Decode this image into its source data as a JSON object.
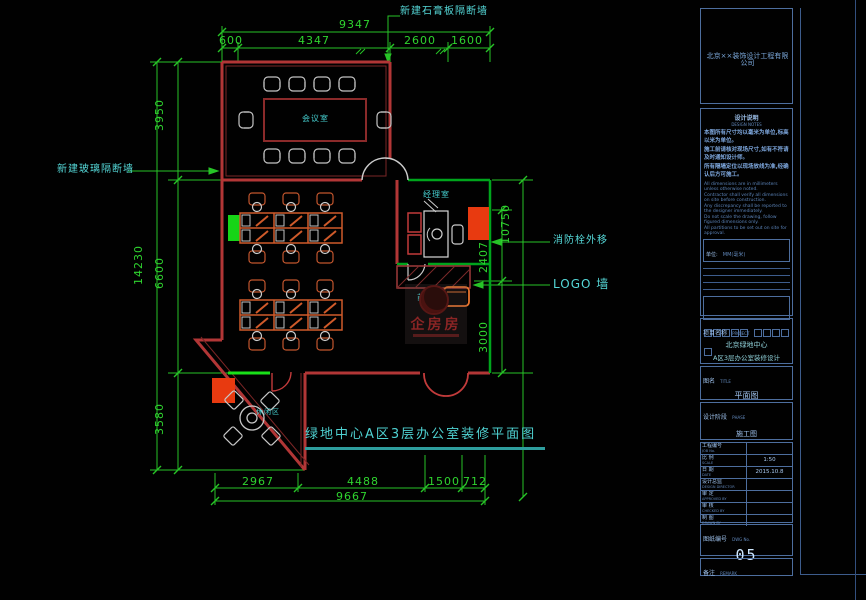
{
  "colors": {
    "background": "#010101",
    "dimension_green": "#2fd42f",
    "wall_red": "#b23636",
    "fill_red": "#e83a10",
    "fill_green": "#17d417",
    "cyan_text": "#4fd2d2",
    "desk_orange": "#cf5a2a",
    "titleblock_border": "#4d6e9e",
    "titleblock_text": "#8fb7e8",
    "watermark_red": "#8b2525"
  },
  "plan": {
    "title": "绿地中心A区3层办公室装修平面图",
    "rooms": {
      "conference": "会议室",
      "manager": "经理室",
      "reception": "前台",
      "leisure": "休闲区"
    },
    "annotations": {
      "top_wall": "新建石膏板隔断墙",
      "left_wall": "新建玻璃隔断墙",
      "hydrant": "消防栓外移",
      "logo_wall": "LOGO 墙"
    },
    "dimensions": {
      "top": {
        "overall": "9347",
        "segments": [
          "600",
          "4347",
          "2600",
          "1600"
        ]
      },
      "left": {
        "overall": "14230",
        "segments": [
          "3950",
          "6600",
          "3580"
        ]
      },
      "right": {
        "overall": "10750",
        "segments": [
          "2407",
          "3000"
        ]
      },
      "bottom": {
        "overall": "9667",
        "segments": [
          "2967",
          "4488",
          "1500",
          "712"
        ]
      }
    }
  },
  "watermark": {
    "text": "企房房"
  },
  "titleblock": {
    "company": "北京××装饰设计工程有限公司",
    "notes_title": "设计说明",
    "notes_subtitle": "DESIGN  NOTES",
    "notes_cn": [
      "本图所有尺寸均以毫米为单位,标高以米为单位。",
      "施工前请核对现场尺寸,如有不符请及时通知设计师。",
      "所有隔墙定位以现场放线为准,经确认后方可施工。"
    ],
    "notes_en": [
      "All dimensions are in millimeters unless otherwise noted.",
      "Contractor shall verify all dimensions on site before construction.",
      "Any discrepancy shall be reported to the designer immediately.",
      "Do not scale the drawing, follow figured dimensions only.",
      "All partitions to be set out on site for approval."
    ],
    "unit_label": "单位:",
    "unit_value": "MM(毫米)",
    "project_label": "项目名称",
    "project_sub": "PROJECT",
    "project_line1": "北京绿地中心",
    "project_line2": "A区3层办公室装修设计",
    "drawing_label": "图名",
    "drawing_sub": "TITLE",
    "drawing_value": "平面图",
    "phase_label": "设计阶段",
    "phase_sub": "PHASE",
    "phase_value": "施工图",
    "rows": [
      {
        "label": "工程编号",
        "sub": "JOB No.",
        "value": ""
      },
      {
        "label": "比 例",
        "sub": "SCALE",
        "value": "1:50"
      },
      {
        "label": "日 期",
        "sub": "DATE",
        "value": "2015.10.8"
      },
      {
        "label": "设计总监",
        "sub": "DESIGN DIRECTOR",
        "value": ""
      },
      {
        "label": "审 定",
        "sub": "APPROVED BY",
        "value": ""
      },
      {
        "label": "审 核",
        "sub": "CHECKED BY",
        "value": ""
      },
      {
        "label": "制 图",
        "sub": "DRAWN BY",
        "value": ""
      }
    ],
    "dwg_label": "图纸编号",
    "dwg_sub": "DWG No.",
    "dwg_no": "05",
    "note_label": "备注",
    "note_sub": "REMARK"
  }
}
